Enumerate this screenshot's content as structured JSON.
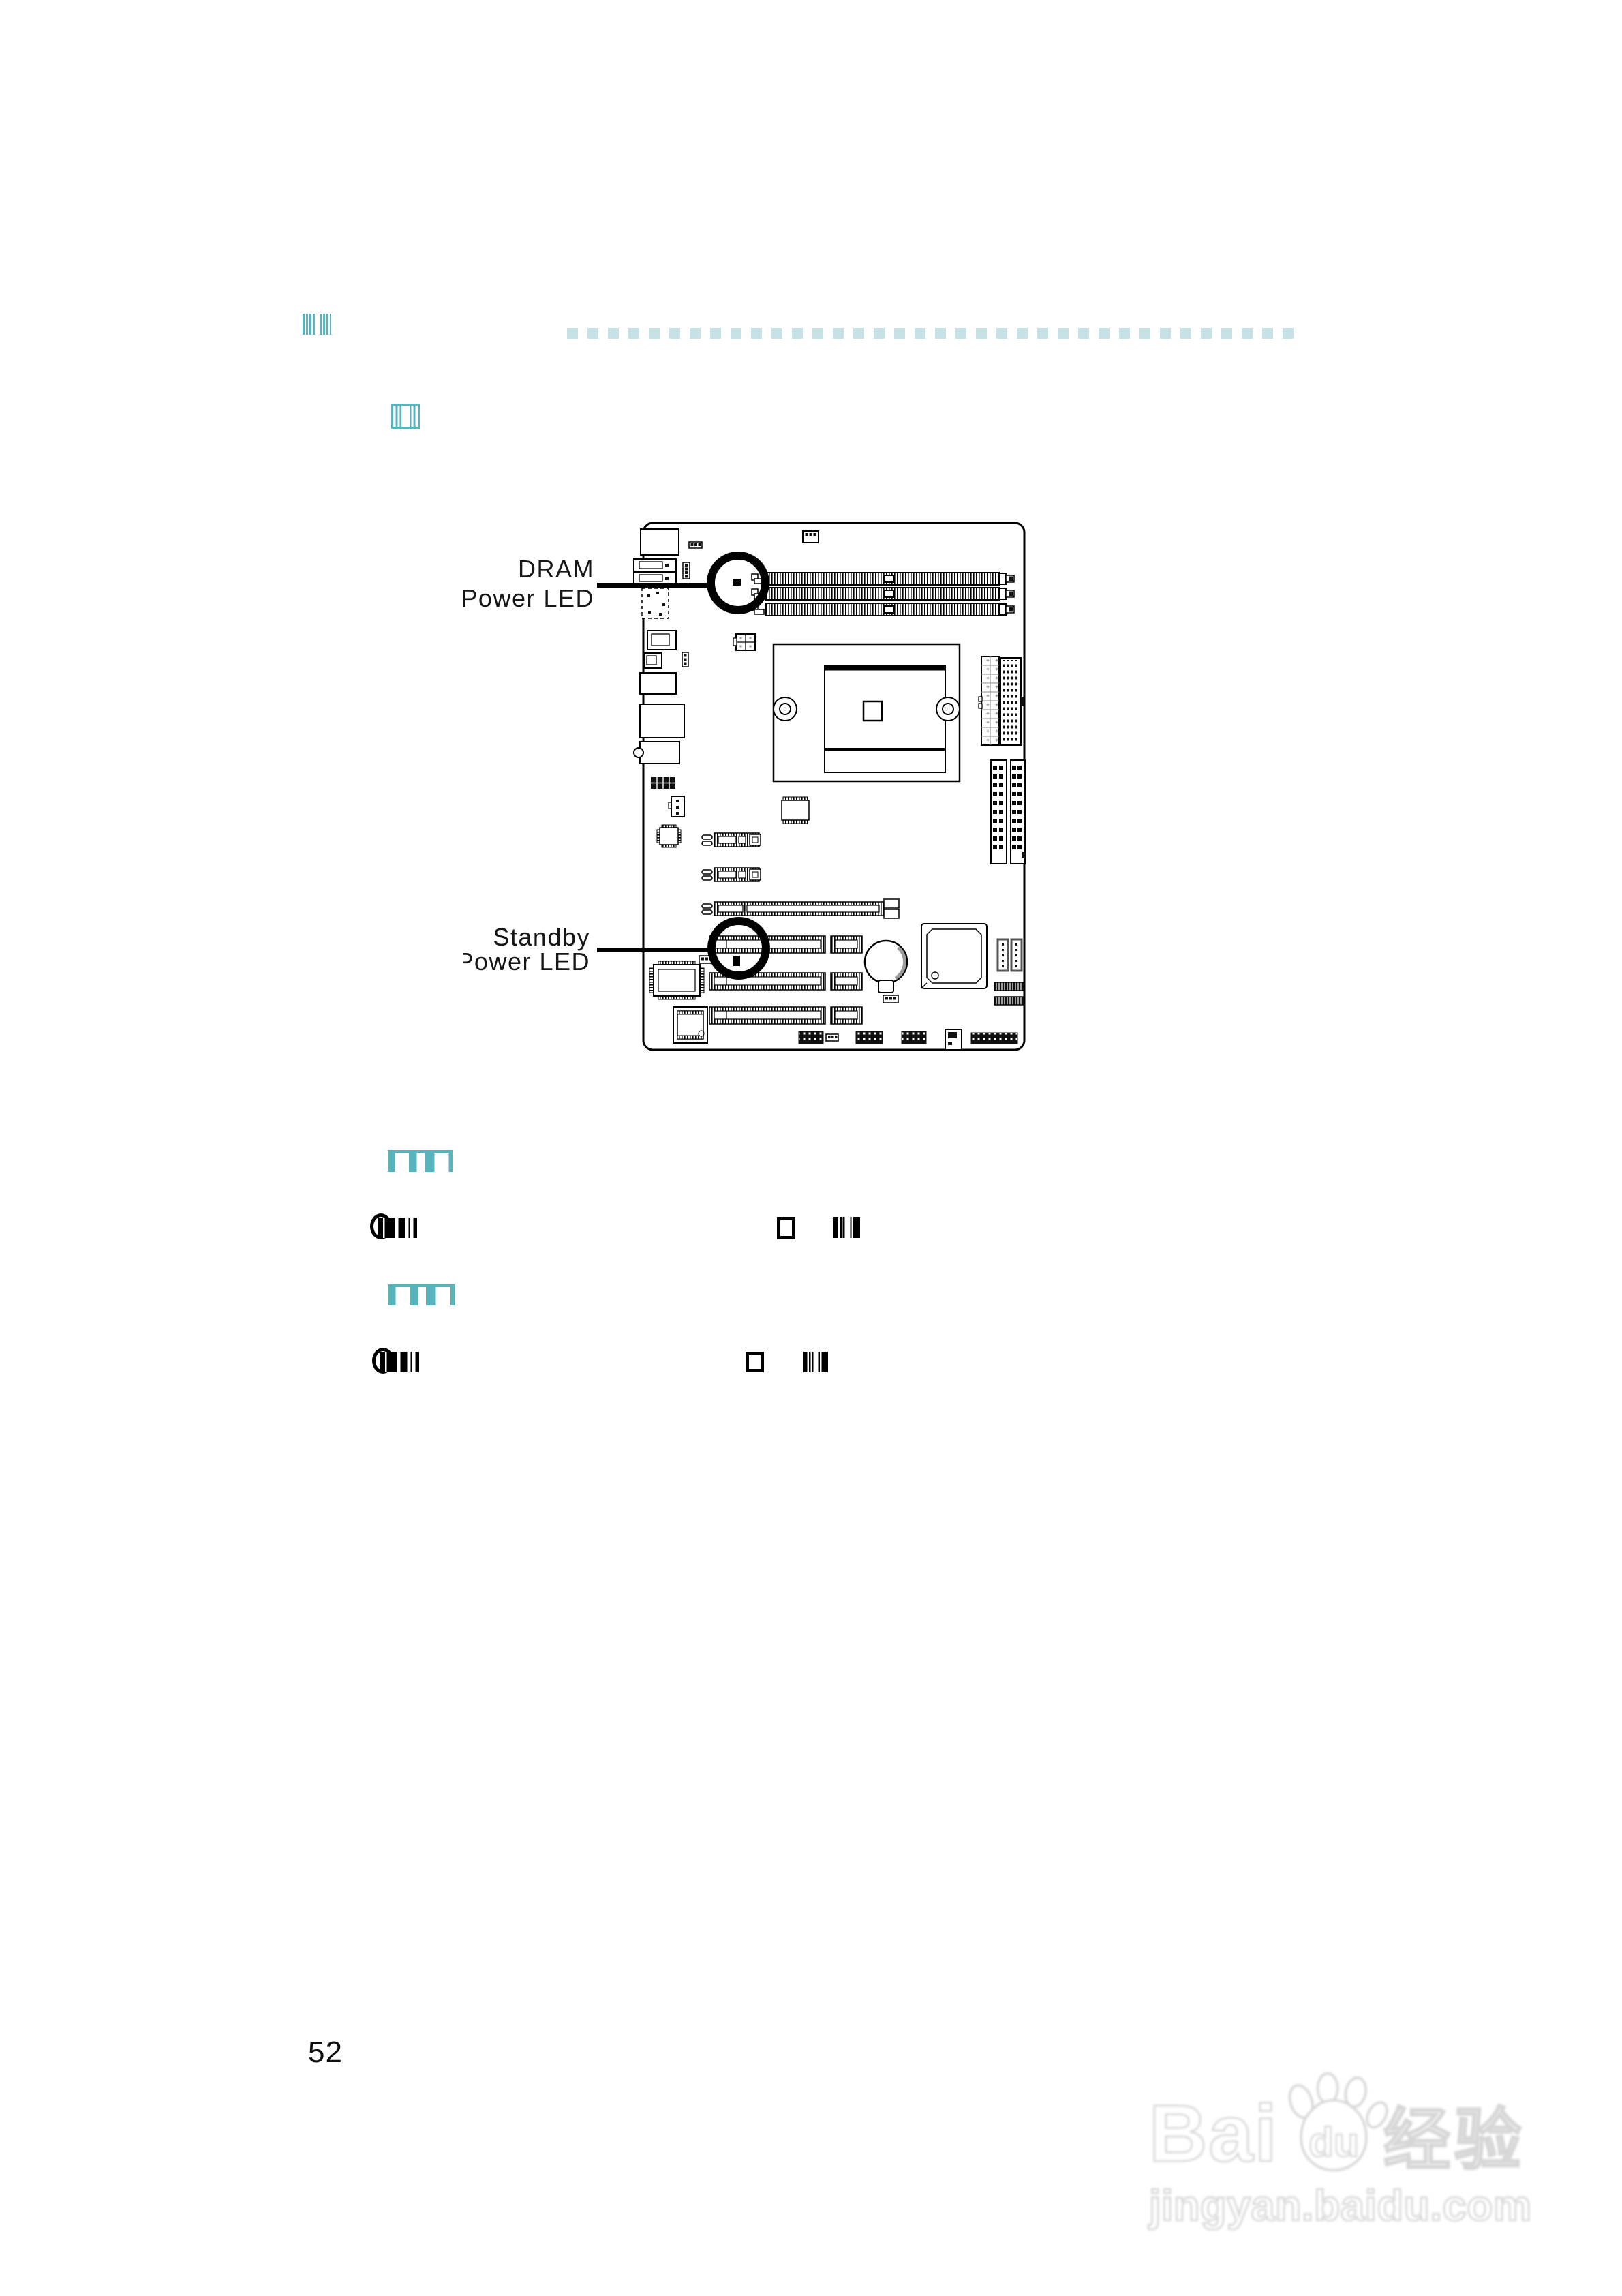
{
  "page": {
    "number": "52"
  },
  "colors": {
    "teal": "#57b4bc",
    "teal_light": "#c7e2e6",
    "line_black": "#000000"
  },
  "figure": {
    "dram_label": {
      "line1": "DRAM",
      "line2": "Power LED"
    },
    "standby_label": {
      "line1": "Standby",
      "line2": "Power LED"
    }
  },
  "watermark": {
    "bai": "Bai",
    "du": "du",
    "cjk": "经验",
    "domain": "jingyan.baidu.com"
  }
}
